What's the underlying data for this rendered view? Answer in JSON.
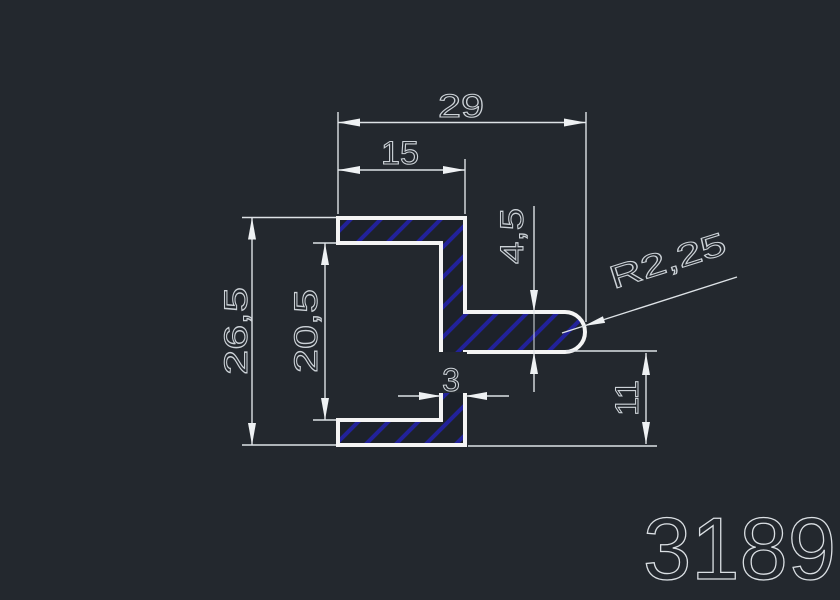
{
  "drawing": {
    "type": "cad-profile-cross-section",
    "part_number": "3189",
    "units": "mm",
    "dimensions": {
      "overall_width": "29",
      "flange_width": "15",
      "stub_thickness": "4,5",
      "tip_radius": "R2,25",
      "overall_height": "26,5",
      "inner_height": "20,5",
      "web_thickness": "3",
      "bottom_offset": "11"
    },
    "colors": {
      "background": "#23282e",
      "profile_outline": "#f4f4f4",
      "hatch": "#22229a",
      "dimension_lines": "#dde2e6",
      "dimension_text": "#ccd2d7"
    }
  }
}
